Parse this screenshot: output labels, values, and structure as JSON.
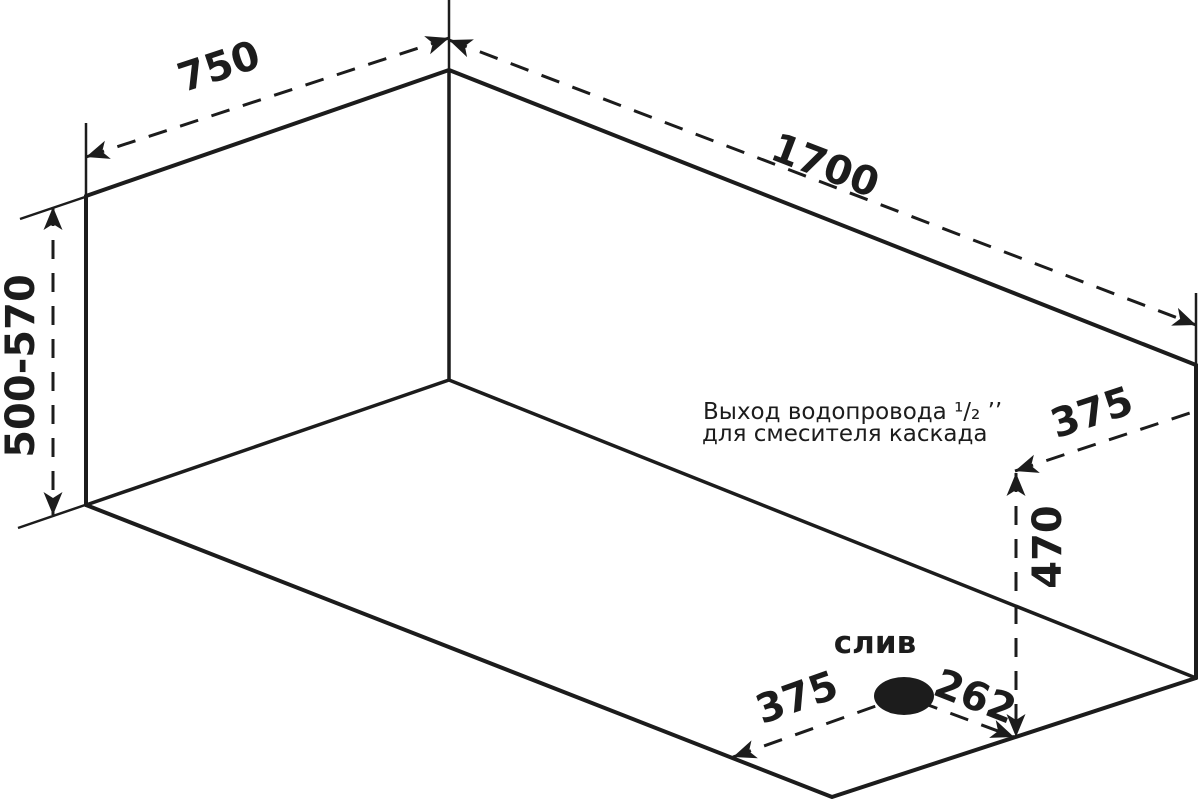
{
  "drawing": {
    "background": "#ffffff",
    "ink": "#1c1c1c",
    "dimensions": {
      "top_width": "750",
      "top_length": "1700",
      "height_range": "500-570",
      "outlet_offset": "375",
      "outlet_height": "470",
      "drain_offset_left": "375",
      "drain_offset_right": "262"
    },
    "labels": {
      "drain": "слив",
      "outlet_note_line1": "Выход водопровода ¹/₂ ’’",
      "outlet_note_line2": "для смесителя каскада"
    }
  }
}
